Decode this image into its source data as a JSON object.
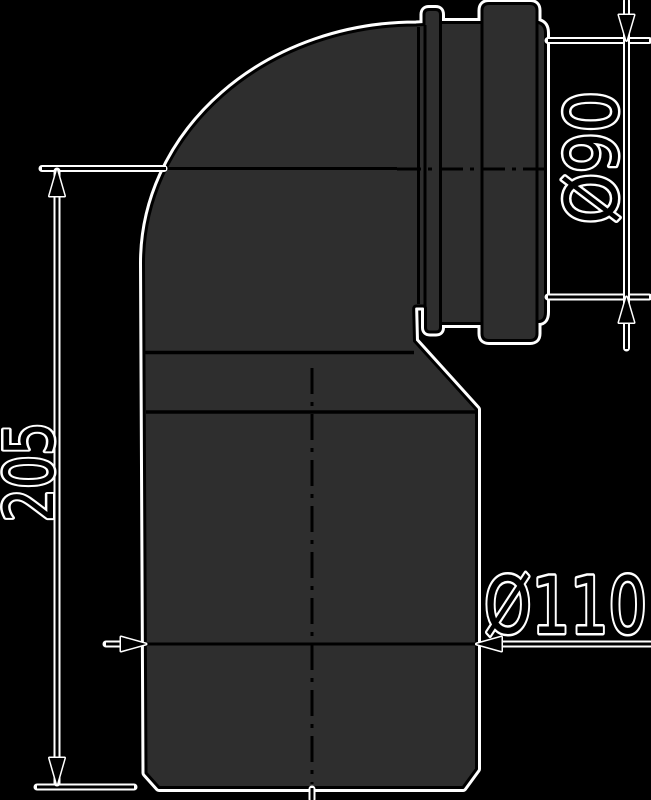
{
  "drawing": {
    "dimension_labels": {
      "height": "205",
      "socket_diameter": "Ø90",
      "outlet_diameter": "Ø110"
    },
    "colors": {
      "background": "#000000",
      "part_fill": "#2e2e2e",
      "line": "#000000",
      "halo": "#ffffff"
    }
  }
}
